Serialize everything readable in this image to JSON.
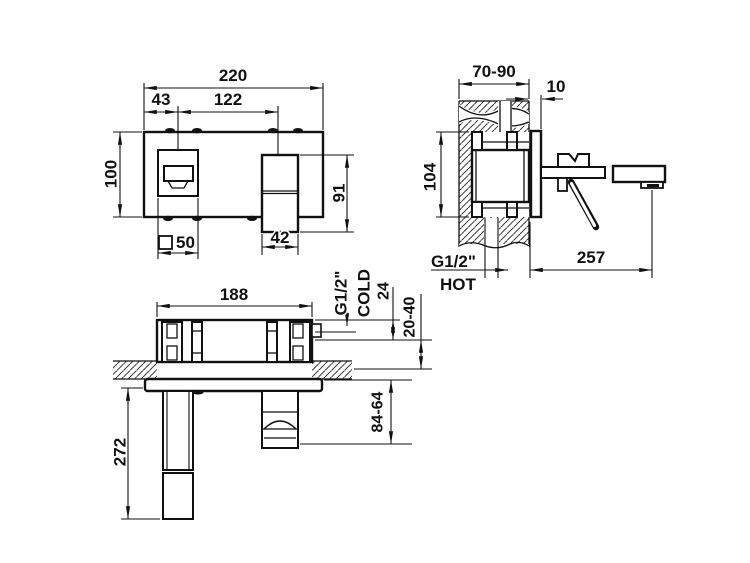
{
  "drawing": {
    "front_view": {
      "dims": {
        "total_width": "220",
        "spout_center_offset": "43",
        "center_distance": "122",
        "plate_height": "100",
        "handle_height": "91",
        "spout_square": "50",
        "handle_width": "42"
      }
    },
    "side_view": {
      "dims": {
        "wall_thickness_range": "70-90",
        "plate_thickness": "10",
        "body_height": "104",
        "spout_projection": "257"
      },
      "labels": {
        "thread_size": "G1/2\"",
        "hot": "HOT"
      }
    },
    "plan_view": {
      "dims": {
        "rough_in_width": "188",
        "inlet_offset": "24",
        "recess_depth_range": "20-40",
        "handle_projection": "84-64",
        "spout_length": "272"
      },
      "labels": {
        "thread_size": "G1/2\"",
        "cold": "COLD"
      }
    }
  }
}
